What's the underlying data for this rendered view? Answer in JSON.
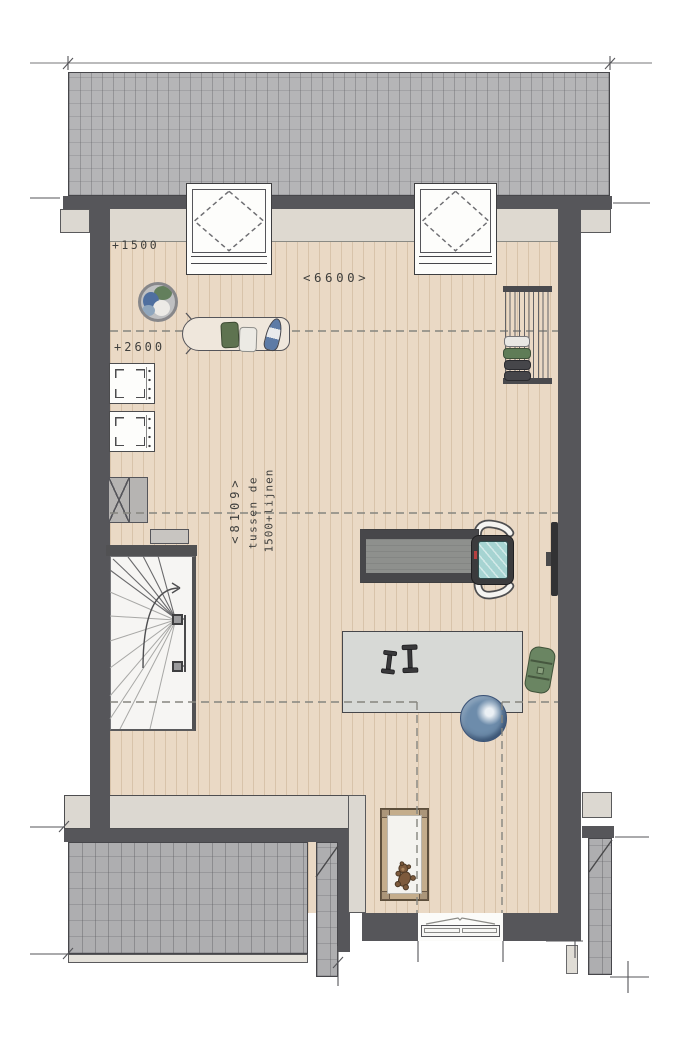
{
  "title": "Attic floor plan",
  "labels": {
    "level_top": "+1500",
    "width_top": "<6600>",
    "level_mid": "+2600",
    "length_left": "<8109>",
    "note_line1": "tussen de",
    "note_line2": "1500+lijnen"
  },
  "icons": {
    "roof_upper": "tiled-roof-plane",
    "skylight": "roof-window-skylight",
    "laundry_basket": "round-laundry-basket",
    "ironing_board": "ironing-board-with-iron",
    "drying_rack": "clothes-drying-rack",
    "washing_machines": "two-stacked-washer-dryer-units",
    "ventilation_unit": "mechanical-ventilation-box",
    "storage_box": "small-storage-box",
    "staircase": "winder-staircase-with-up-arrow",
    "treadmill": "treadmill-with-console",
    "tv": "wall-mounted-tv",
    "exercise_mat": "exercise-mat",
    "dumbbells": "two-dumbbells",
    "gym_ball": "blue-gym-ball",
    "yoga_roll": "rolled-yoga-mat",
    "baby_cot": "baby-cot-with-teddy-bear",
    "window_bottom": "facade-window",
    "roof_lower": "lower-tiled-roof-planes"
  },
  "colors": {
    "roof_tile": "#b5b5b7",
    "wall": "#56565a",
    "floor_wood": "#ead9c5",
    "headroom_strip": "#ded9d0",
    "dashed_line": "#85857f",
    "stair_floor": "#f6f5f3",
    "mat": "#d7d9d6",
    "gym_ball": "#5d80a6",
    "yoga_mat_green": "#6a8562",
    "treadmill_screen": "#a6d4d2",
    "label_text": "#3f3f3d"
  }
}
